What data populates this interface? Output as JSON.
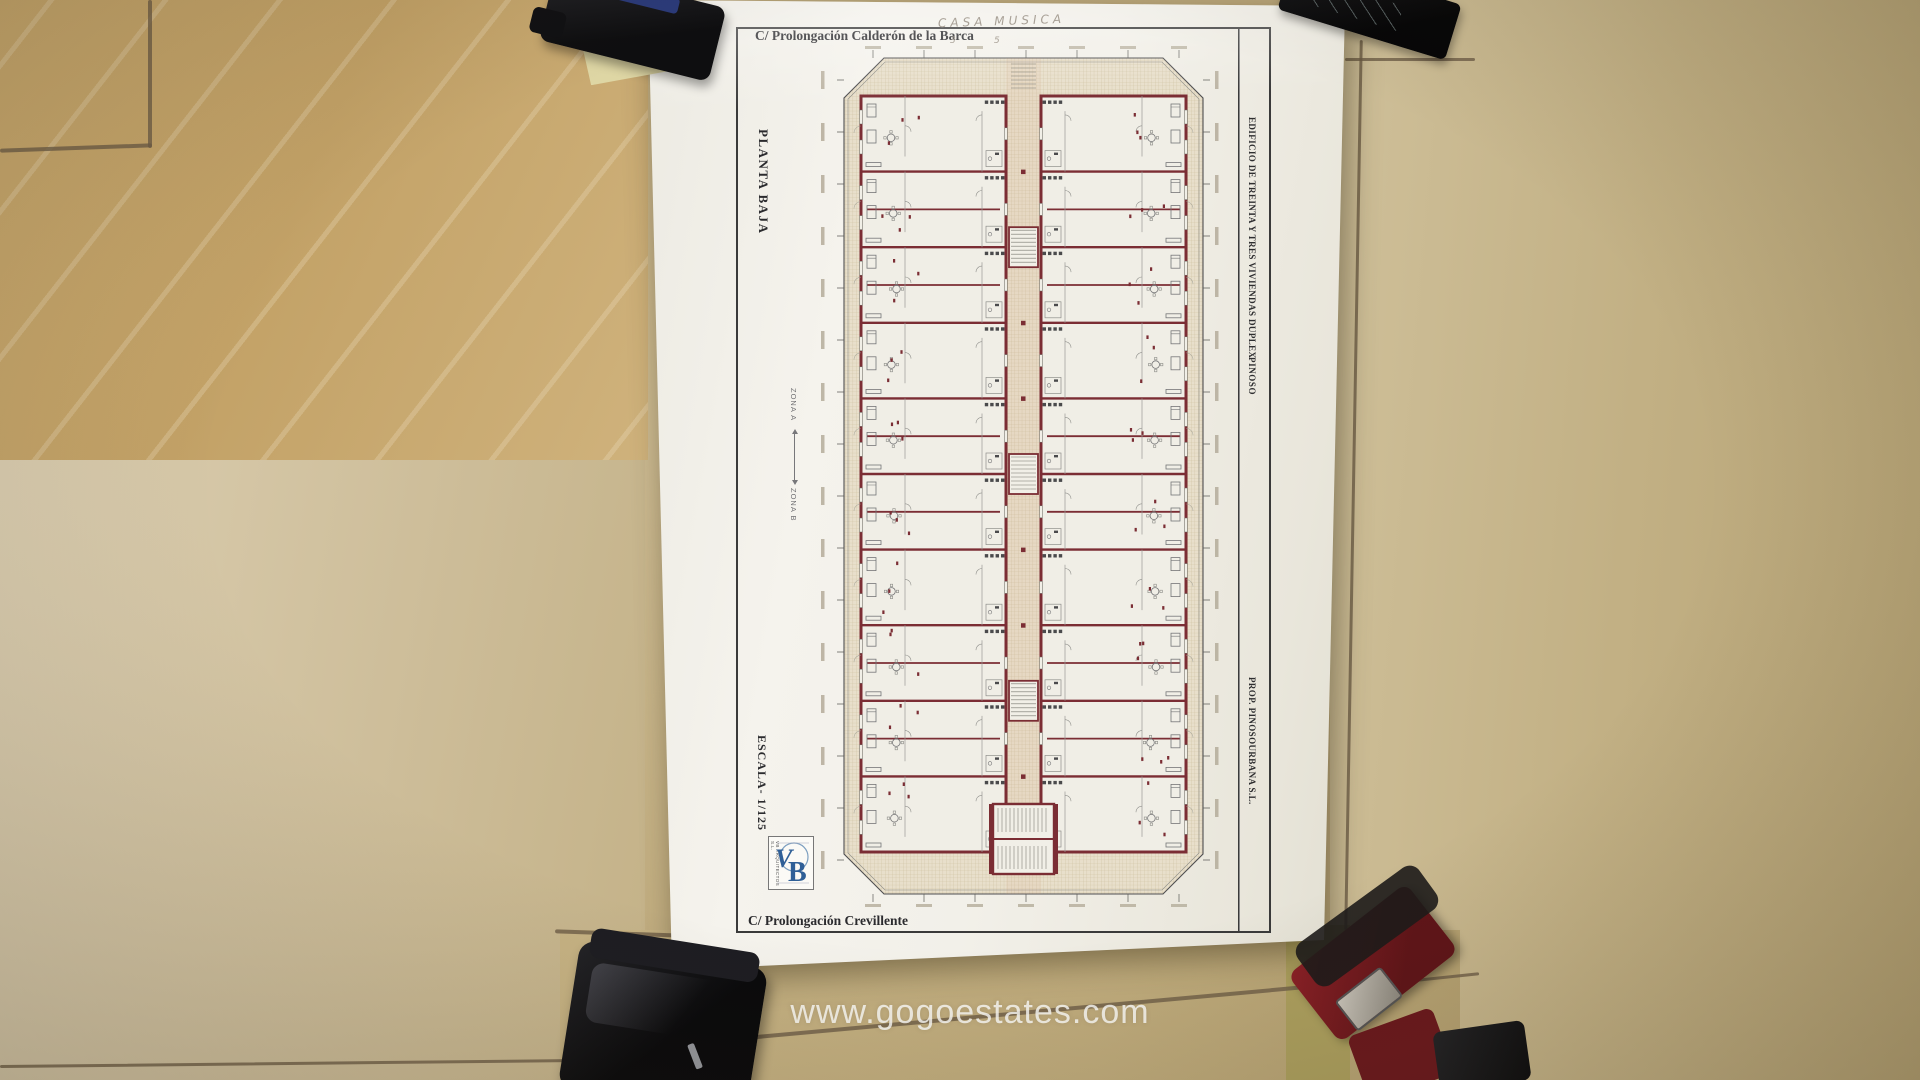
{
  "scene": {
    "watermark": "www.gogoestates.com",
    "objects": [
      "hole-punch",
      "sticky-note",
      "black-tool",
      "smartphone",
      "red-stapler",
      "corner-object"
    ]
  },
  "document": {
    "street_top": "C/ Prolongación Calderón de la Barca",
    "street_bottom": "C/ Prolongación Crevillente",
    "handwritten_note": "CASA  MUSICA",
    "handwritten_marks": [
      "3",
      "5"
    ],
    "orientation_label": "PLANTA BAJA",
    "scale_label": "ESCALA- 1/125",
    "zone_a_label": "ZONA A",
    "zone_b_label": "ZONA B",
    "title_block": {
      "project_title": "EDIFICIO DE TREINTA Y TRES VIVIENDAS DUPLEX",
      "location": "PINOSO",
      "developer": "PROP.  PINOSOURBANA S.L."
    },
    "architect_logo": {
      "monogram_v": "V",
      "monogram_b": "B",
      "caption": "VB ARQUITECTOS S.L."
    }
  },
  "plan": {
    "rows": 10,
    "colors": {
      "wall": "#7b2d34",
      "hatch_bg": "#e8dfcb",
      "hatch_line": "#ccbf9e",
      "tint": "#d49a82",
      "line": "#5a5a5c",
      "furniture": "#757577",
      "dark_fixture": "#4a4a4c",
      "room": "#f0eee6",
      "paper": "#f1efe7"
    }
  }
}
